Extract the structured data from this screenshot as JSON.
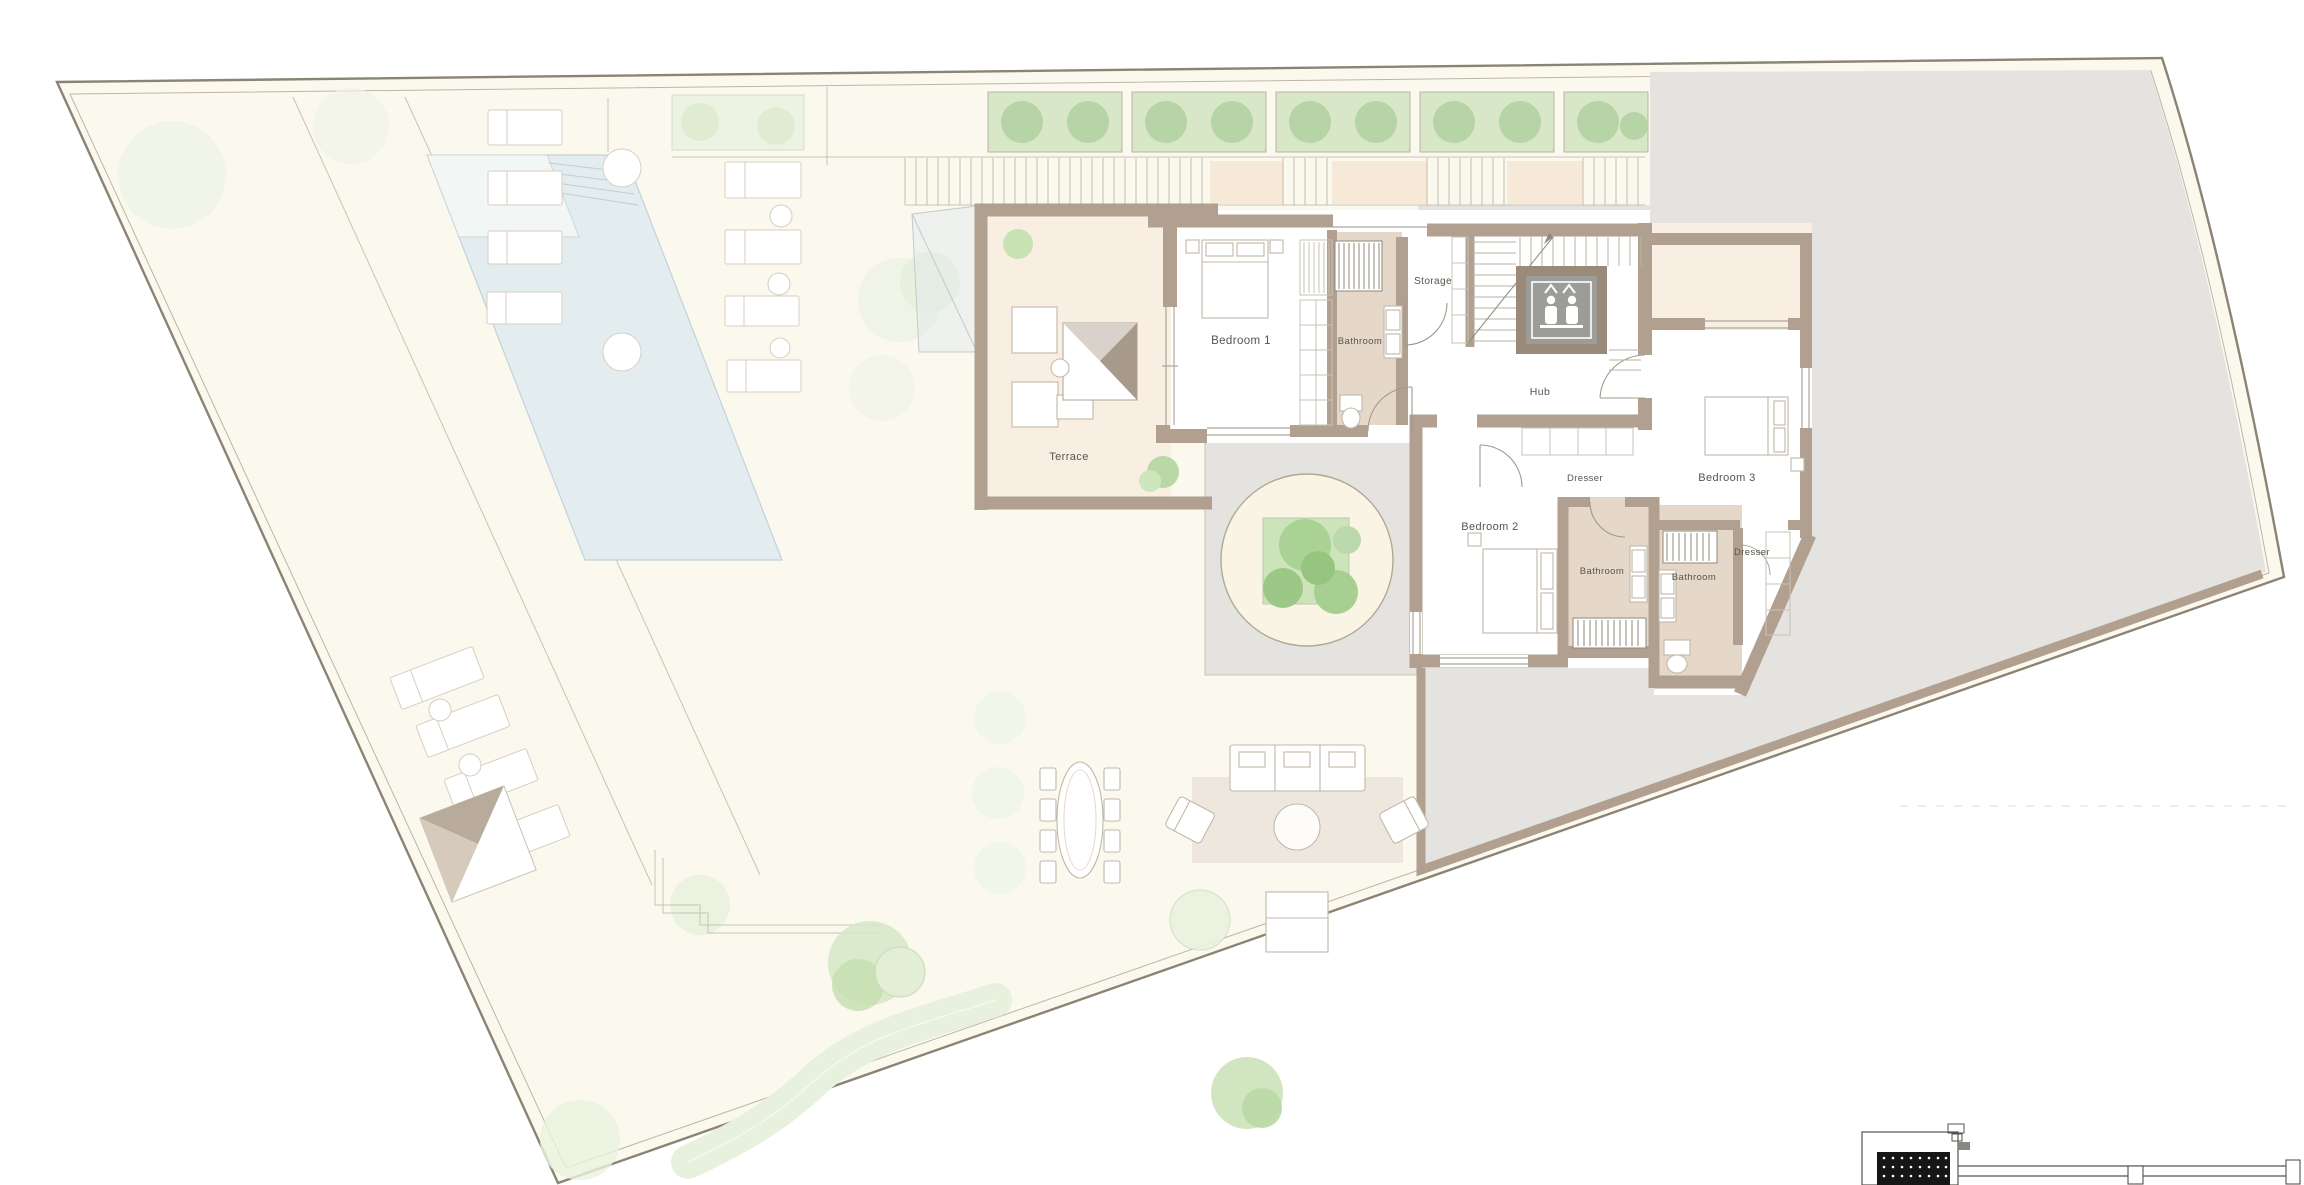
{
  "floor_plan": {
    "rooms": [
      {
        "label": "Bedroom 1"
      },
      {
        "label": "Bathroom"
      },
      {
        "label": "Storage"
      },
      {
        "label": "Hub"
      },
      {
        "label": "Dresser"
      },
      {
        "label": "Bedroom 3"
      },
      {
        "label": "Bedroom 2"
      },
      {
        "label": "Bathroom"
      },
      {
        "label": "Bathroom"
      },
      {
        "label": "Dresser"
      },
      {
        "label": "Terrace"
      }
    ],
    "icons": [
      {
        "name": "elevator-icon",
        "meaning": "lift with two passengers"
      }
    ],
    "colors": {
      "site_fill": "#fbf8ee",
      "paving_gray": "#e4e3e0",
      "wall": "#b1a08f",
      "bathroom_floor": "#e6d8c9",
      "terrace_floor": "#f8efe2",
      "pool": "#e3edf0",
      "hedge": "#d7e7c8",
      "tree": "#b9d8a6",
      "boundary": "#8b8474"
    }
  }
}
